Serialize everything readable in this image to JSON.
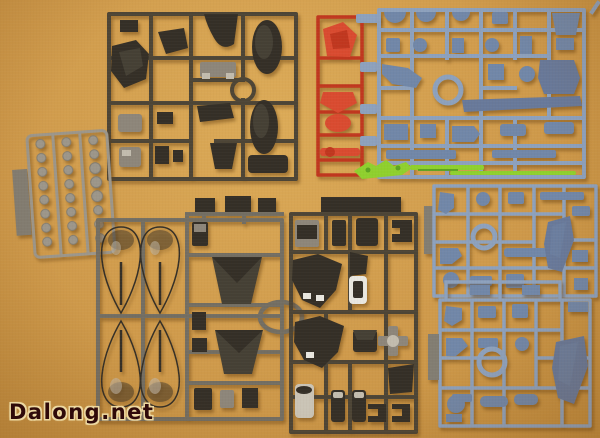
{
  "scene": {
    "type": "photograph",
    "subject": "Plastic model kit runners (sprues) laid out on a tan surface"
  },
  "watermark": {
    "text": "Dalong.net"
  },
  "colors": {
    "bg": "#cf9a4b",
    "bgLight": "#dcab58",
    "bgDark": "#b98538",
    "oliveFrame": "#4d4536",
    "grayFrame": "#736e63",
    "partDark": "#454035",
    "partDeep": "#342f27",
    "sheen": "#8d867a",
    "silver": "#c2bcae",
    "red": "#c0371f",
    "redBright": "#d94b30",
    "blue": "#8da1bd",
    "blueDark": "#7187a8",
    "bladeBlue": "#68799a",
    "green": "#8fd02e",
    "greenDark": "#5da321",
    "poly": "#9c968a",
    "polyDark": "#827d72",
    "white": "#e9e7e0",
    "lightPart": "#cac4b6",
    "wmText": "#2f0a0a",
    "wmHalo": "#edd9a2"
  },
  "sprues": [
    {
      "id": "top-left-dark",
      "plastic_color": "dark gray",
      "contents": "hull covers, faceted shield, ring gate, small armor parts"
    },
    {
      "id": "red",
      "plastic_color": "red",
      "contents": "faceted chest piece, front skirt, small trim parts"
    },
    {
      "id": "top-right-blue",
      "plastic_color": "blue-gray",
      "contents": "rifle parts, frame joints, central ring gate"
    },
    {
      "id": "beam-sabers",
      "plastic_color": "clear green",
      "contents": "beam saber blades"
    },
    {
      "id": "polycaps",
      "plastic_color": "light gray",
      "contents": "grid of round polycap joints"
    },
    {
      "id": "legs-dark",
      "plastic_color": "dark gray",
      "contents": "four teardrop leg armor shells, funnel skirts, ring gate"
    },
    {
      "id": "torso-dark",
      "plastic_color": "dark gray",
      "contents": "chest armor, cylinders, white sensor part, crosshair part"
    },
    {
      "id": "right-upper-blue",
      "plastic_color": "blue-gray",
      "contents": "curved skirt blade, ring gate, small joint parts"
    },
    {
      "id": "right-lower-blue",
      "plastic_color": "blue-gray",
      "contents": "curved skirt blade, ring gate, small joint parts"
    }
  ]
}
